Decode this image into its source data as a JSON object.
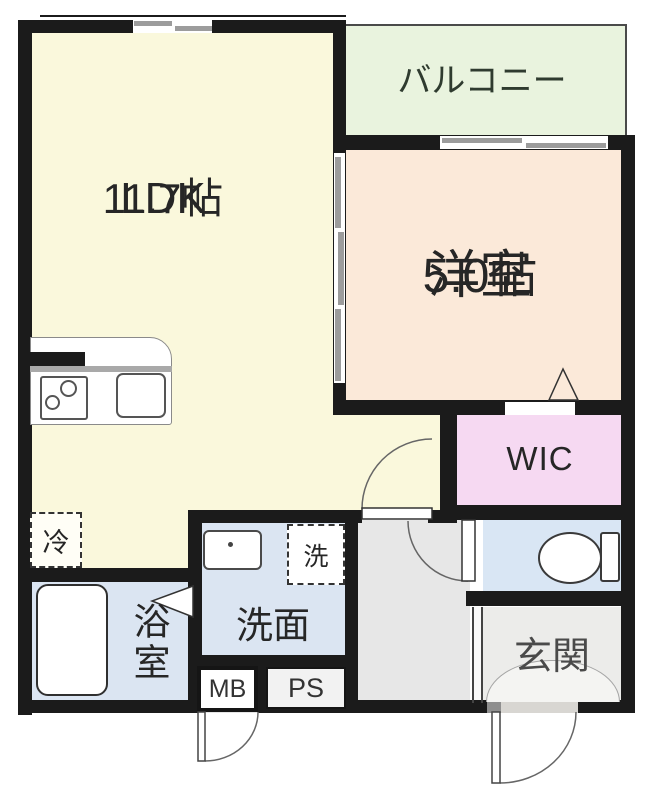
{
  "floor_plan": {
    "rooms": {
      "ldk": {
        "name": "LDK",
        "size": "11.7帖"
      },
      "balcony": {
        "name": "バルコニー"
      },
      "western_room": {
        "name": "洋室",
        "size": "5.0帖"
      },
      "wic": {
        "name": "WIC"
      },
      "washroom": {
        "name": "洗面"
      },
      "bathroom": {
        "name": "浴室"
      },
      "entrance": {
        "name": "玄関"
      }
    },
    "labels": {
      "meter_box": "MB",
      "pipe_space": "PS",
      "refrigerator": "冷",
      "washer": "洗"
    },
    "colors": {
      "wall": "#1b1b1b",
      "ldk_fill": "#faf8dc",
      "western_room_fill": "#fbe9d9",
      "balcony_fill": "#e9f3de",
      "wic_fill": "#f6d9f2",
      "wet_area_fill": "#dbe5f2",
      "toilet_fill": "#d9e6f4",
      "hallway_fill": "#e7e7e7",
      "entrance_fill": "#ececea",
      "window_gray": "#9c9c9c"
    }
  }
}
